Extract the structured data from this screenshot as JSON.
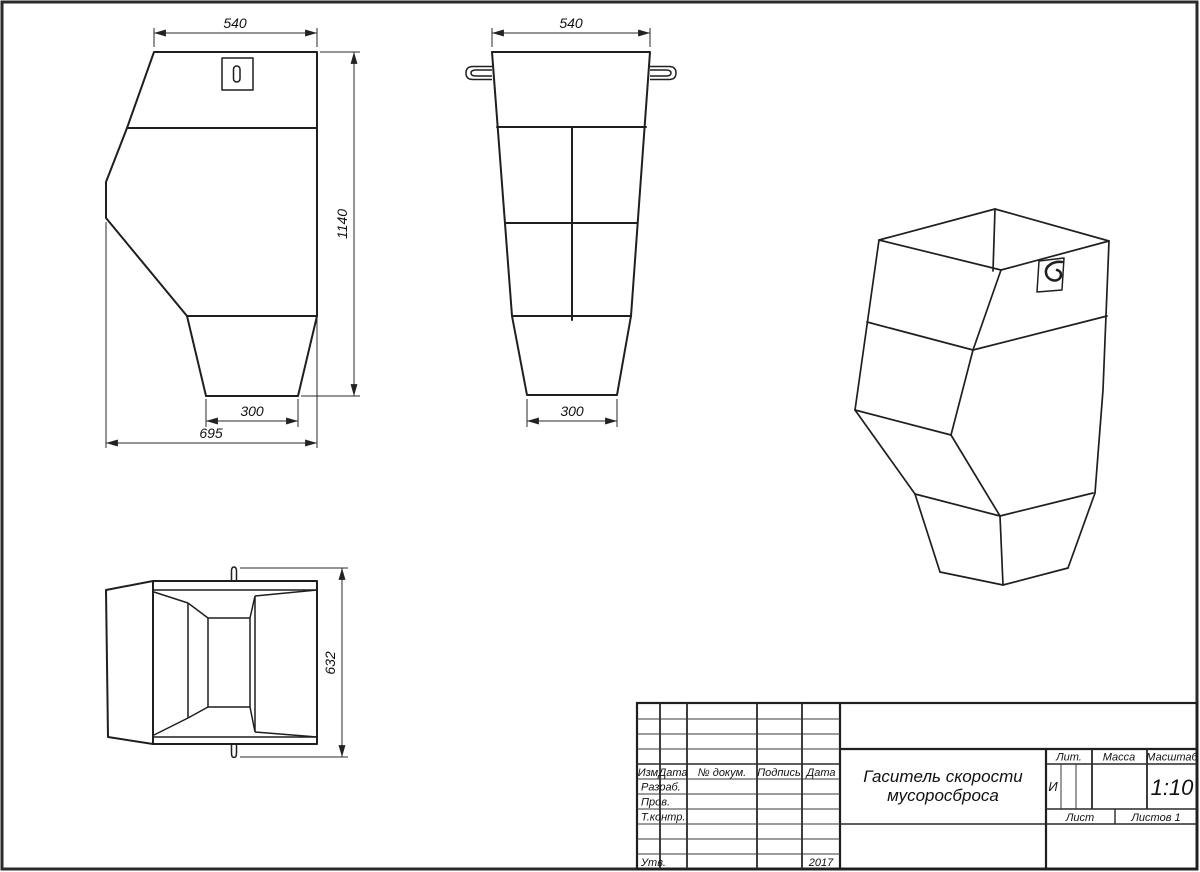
{
  "colors": {
    "line": "#1f1f1f",
    "background": "#ffffff"
  },
  "dimensions": {
    "front_top_width": "540",
    "front_height": "1140",
    "front_outlet_width": "300",
    "front_overall_width": "695",
    "side_top_width": "540",
    "side_outlet_width": "300",
    "top_view_depth": "632"
  },
  "title_block": {
    "name_line1": "Гаситель скорости",
    "name_line2": "мусоросброса",
    "col_izm": "Изм",
    "col_data1": "Дата",
    "col_doc": "№ докум.",
    "col_sign": "Подпись",
    "col_data2": "Дата",
    "row_razrab": "Разраб.",
    "row_prov": "Пров.",
    "row_tkontr": "Т.контр.",
    "row_utv": "Утв.",
    "year": "2017",
    "lit_label": "Лит.",
    "mass_label": "Масса",
    "scale_label": "Масштаб",
    "lit_value": "И",
    "scale_value": "1:10",
    "list_label": "Лист",
    "listov_label": "Листов 1"
  }
}
